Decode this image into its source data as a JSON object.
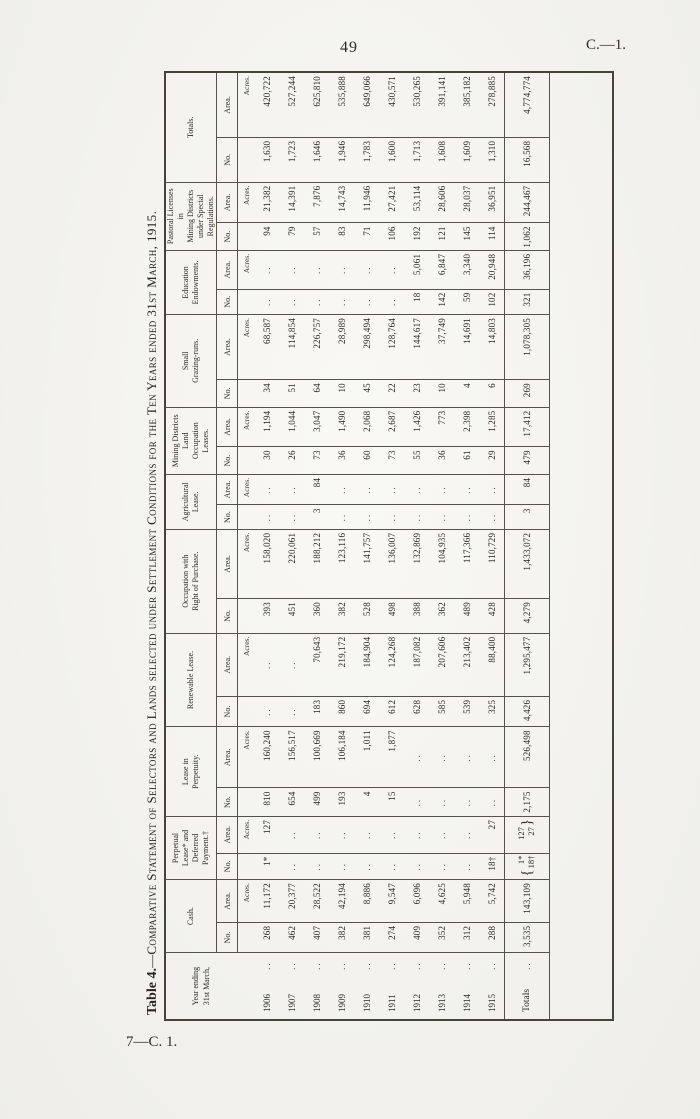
{
  "page": {
    "number": "49",
    "doc_ref": "C.—1.",
    "footer_ref": "7—C. 1."
  },
  "table": {
    "title_prefix": "Table 4.",
    "title_rest": "—Comparative Statement of Selectors and Lands selected under Settlement Conditions for the Ten Years ended 31st March, 1915.",
    "year_header_lines": [
      "Year ending",
      "31st March,"
    ],
    "subheader": {
      "no": "No.",
      "area": "Area."
    },
    "unit_label": "Acres.",
    "empty_marker": "..",
    "row_dots": "..",
    "groups": [
      {
        "label_lines": [
          "Cash."
        ]
      },
      {
        "label_lines": [
          "Perpetual",
          "Lease* and",
          "Deferred",
          "Payment.†"
        ]
      },
      {
        "label_lines": [
          "Lease in",
          "Perpetuity."
        ]
      },
      {
        "label_lines": [
          "Renewable Lease."
        ]
      },
      {
        "label_lines": [
          "Occupation with",
          "Right of Purchase."
        ]
      },
      {
        "label_lines": [
          "Agricultural",
          "Lease."
        ]
      },
      {
        "label_lines": [
          "Mining Districts",
          "Land",
          "Occupation",
          "Leases."
        ]
      },
      {
        "label_lines": [
          "Small",
          "Grazing-runs."
        ]
      },
      {
        "label_lines": [
          "Education",
          "Endowments."
        ]
      },
      {
        "label_lines": [
          "Pastoral Licenses",
          "in",
          "Mining Districts",
          "under Special",
          "Regulations."
        ]
      },
      {
        "label_lines": [
          "Totals."
        ]
      }
    ],
    "rows": [
      {
        "year": "1906",
        "cells": [
          "268",
          "11,172",
          "1*",
          "127",
          "810",
          "160,240",
          "..",
          "..",
          "393",
          "158,020",
          "..",
          "..",
          "30",
          "1,194",
          "34",
          "68,587",
          "..",
          "..",
          "94",
          "21,382",
          "1,630",
          "420,722"
        ]
      },
      {
        "year": "1907",
        "cells": [
          "462",
          "20,377",
          "..",
          "..",
          "654",
          "156,517",
          "..",
          "..",
          "451",
          "220,061",
          "..",
          "..",
          "26",
          "1,044",
          "51",
          "114,854",
          "..",
          "..",
          "79",
          "14,391",
          "1,723",
          "527,244"
        ]
      },
      {
        "year": "1908",
        "cells": [
          "407",
          "28,522",
          "..",
          "..",
          "499",
          "100,669",
          "183",
          "70,643",
          "360",
          "188,212",
          "3",
          "84",
          "73",
          "3,047",
          "64",
          "226,757",
          "..",
          "..",
          "57",
          "7,876",
          "1,646",
          "625,810"
        ]
      },
      {
        "year": "1909",
        "cells": [
          "382",
          "42,194",
          "..",
          "..",
          "193",
          "106,184",
          "860",
          "219,172",
          "382",
          "123,116",
          "..",
          "..",
          "36",
          "1,490",
          "10",
          "28,989",
          "..",
          "..",
          "83",
          "14,743",
          "1,946",
          "535,888"
        ]
      },
      {
        "year": "1910",
        "cells": [
          "381",
          "8,886",
          "..",
          "..",
          "4",
          "1,011",
          "694",
          "184,904",
          "528",
          "141,757",
          "..",
          "..",
          "60",
          "2,068",
          "45",
          "298,494",
          "..",
          "..",
          "71",
          "11,946",
          "1,783",
          "649,066"
        ]
      },
      {
        "year": "1911",
        "cells": [
          "274",
          "9,547",
          "..",
          "..",
          "15",
          "1,877",
          "612",
          "124,268",
          "498",
          "136,007",
          "..",
          "..",
          "73",
          "2,687",
          "22",
          "128,764",
          "..",
          "..",
          "106",
          "27,421",
          "1,600",
          "430,571"
        ]
      },
      {
        "year": "1912",
        "cells": [
          "409",
          "6,096",
          "..",
          "..",
          "..",
          "..",
          "628",
          "187,082",
          "388",
          "132,869",
          "..",
          "..",
          "55",
          "1,426",
          "23",
          "144,617",
          "18",
          "5,061",
          "192",
          "53,114",
          "1,713",
          "530,265"
        ]
      },
      {
        "year": "1913",
        "cells": [
          "352",
          "4,625",
          "..",
          "..",
          "..",
          "..",
          "585",
          "207,606",
          "362",
          "104,935",
          "..",
          "..",
          "36",
          "773",
          "10",
          "37,749",
          "142",
          "6,847",
          "121",
          "28,606",
          "1,608",
          "391,141"
        ]
      },
      {
        "year": "1914",
        "cells": [
          "312",
          "5,948",
          "..",
          "..",
          "..",
          "..",
          "539",
          "213,402",
          "489",
          "117,366",
          "..",
          "..",
          "61",
          "2,398",
          "4",
          "14,691",
          "59",
          "3,340",
          "145",
          "28,037",
          "1,609",
          "385,182"
        ]
      },
      {
        "year": "1915",
        "cells": [
          "288",
          "5,742",
          "18†",
          "27",
          "..",
          "..",
          "325",
          "88,400",
          "428",
          "110,729",
          "..",
          "..",
          "29",
          "1,285",
          "6",
          "14,803",
          "102",
          "20,948",
          "114",
          "36,951",
          "1,310",
          "278,885"
        ]
      }
    ],
    "totals": {
      "label": "Totals",
      "cells": [
        "3,535",
        "143,109",
        {
          "brace": "left",
          "lines": [
            "1*",
            "18†"
          ]
        },
        {
          "brace": "right",
          "lines": [
            "127",
            "27"
          ]
        },
        "2,175",
        "526,498",
        "4,426",
        "1,295,477",
        "4,279",
        "1,433,072",
        "3",
        "84",
        "479",
        "17,412",
        "269",
        "1,078,305",
        "321",
        "36,196",
        "1,062",
        "244,467",
        "16,568",
        "4,774,774"
      ]
    }
  }
}
